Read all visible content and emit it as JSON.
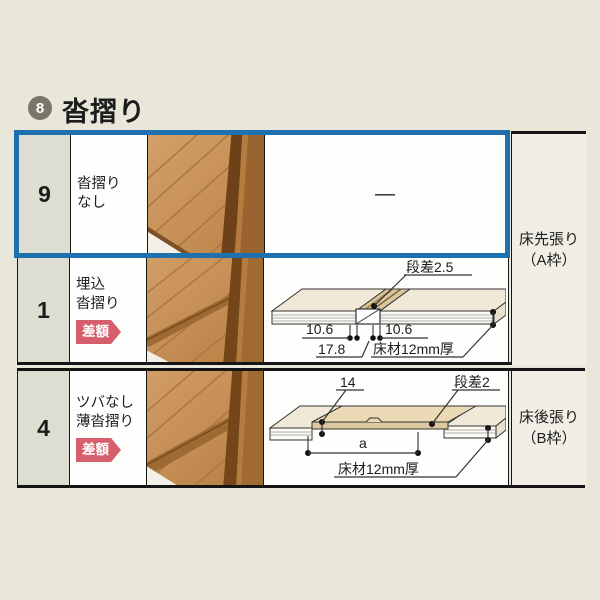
{
  "header": {
    "index_number": "8",
    "title": "沓摺り"
  },
  "rows": [
    {
      "num": "9",
      "label_line1": "沓摺り",
      "label_line2": "なし",
      "diagram_dash": "—"
    },
    {
      "num": "1",
      "label_line1": "埋込",
      "label_line2": "沓摺り",
      "badge": "差額"
    },
    {
      "num": "4",
      "label_line1": "ツバなし",
      "label_line2": "薄沓摺り",
      "badge": "差額"
    }
  ],
  "side_labels": {
    "a": {
      "line1": "床先張り",
      "line2": "（A枠）"
    },
    "b": {
      "line1": "床後張り",
      "line2": "（B枠）"
    }
  },
  "diagram_embedded": {
    "step": "段差2.5",
    "dim_left": "10.6",
    "dim_right": "10.6",
    "dim_width": "17.8",
    "material": "床材12mm厚"
  },
  "diagram_thin": {
    "dim_lip": "14",
    "step": "段差2",
    "dim_span": "a",
    "material": "床材12mm厚"
  },
  "colors": {
    "highlight_border": "#1e70ae",
    "badge_background": "#d65f6e",
    "index_circle": "#7c7569",
    "page_background": "#e9e6da"
  }
}
